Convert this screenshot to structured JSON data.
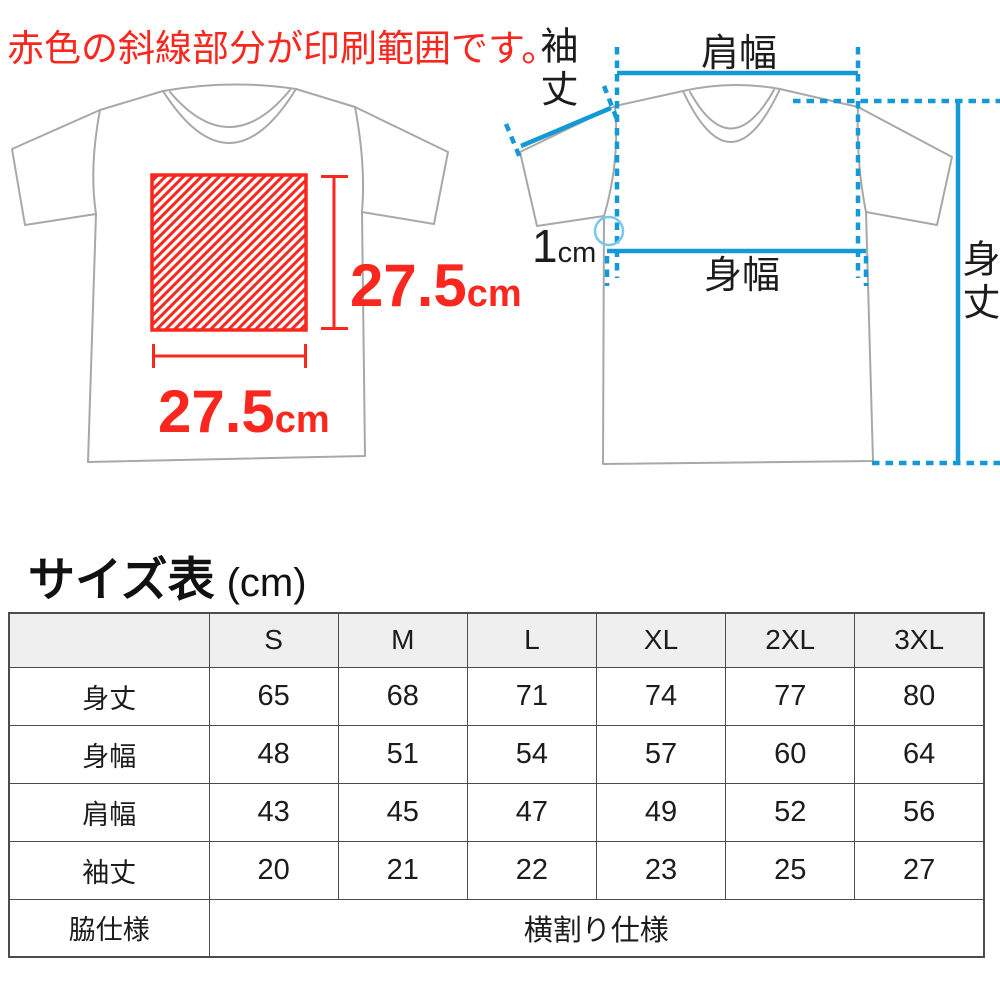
{
  "notice": "赤色の斜線部分が印刷範囲です。",
  "print_area": {
    "height": {
      "value": "27.5",
      "unit": "cm"
    },
    "width": {
      "value": "27.5",
      "unit": "cm"
    }
  },
  "diagram": {
    "sleeve_length_label": "袖丈",
    "shoulder_width_label": "肩幅",
    "body_width_label": "身幅",
    "body_length_label": "身丈",
    "collar_offset": {
      "value": "1",
      "unit": "cm"
    }
  },
  "colors": {
    "print_red": "#fa271e",
    "measure_cyan": "#1599d6",
    "shirt_outline_gray": "#a8a8a8"
  },
  "size_table": {
    "title": "サイズ表",
    "unit": "(cm)",
    "corner": "",
    "columns": [
      "S",
      "M",
      "L",
      "XL",
      "2XL",
      "3XL"
    ],
    "rows": [
      {
        "label": "身丈",
        "values": [
          "65",
          "68",
          "71",
          "74",
          "77",
          "80"
        ]
      },
      {
        "label": "身幅",
        "values": [
          "48",
          "51",
          "54",
          "57",
          "60",
          "64"
        ]
      },
      {
        "label": "肩幅",
        "values": [
          "43",
          "45",
          "47",
          "49",
          "52",
          "56"
        ]
      },
      {
        "label": "袖丈",
        "values": [
          "20",
          "21",
          "22",
          "23",
          "25",
          "27"
        ]
      }
    ],
    "spec_row": {
      "label": "脇仕様",
      "value": "横割り仕様"
    }
  }
}
